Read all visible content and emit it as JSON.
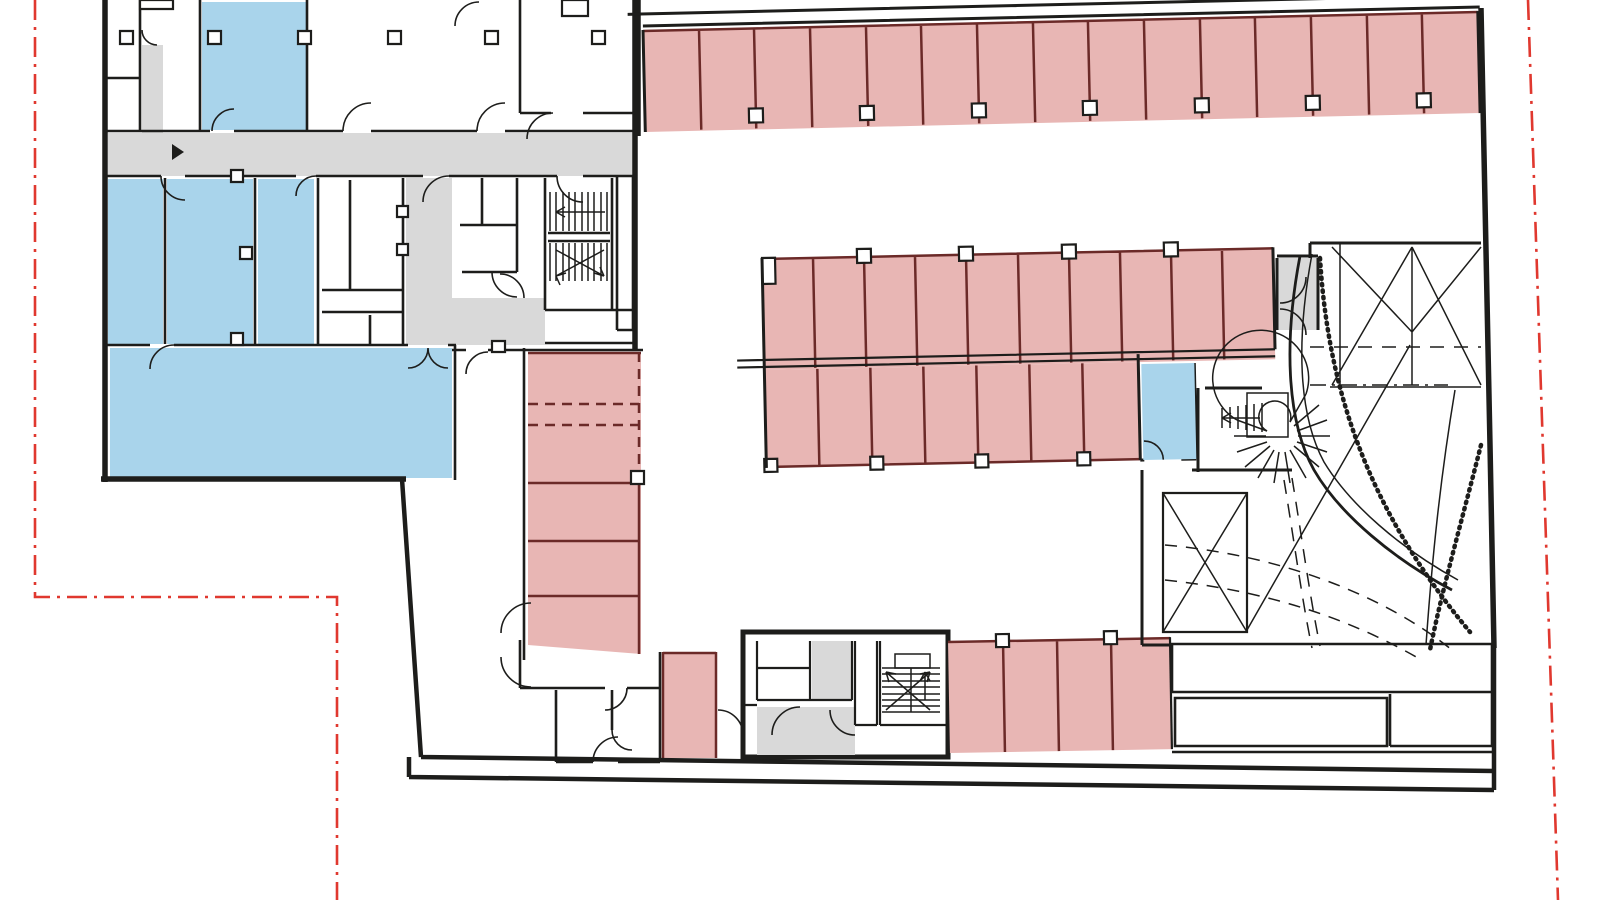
{
  "page": {
    "kind": "architectural floor plan drawing",
    "level": "parking / garage level",
    "visible_text": ""
  },
  "plan": {
    "colors": {
      "wall": "#1d1d1b",
      "parking": "#e8b6b4",
      "stall_line": "#6b2a28",
      "room_blue": "#a9d4eb",
      "circulation": "#d9d9d9",
      "boundary": "#e0382f",
      "ramp_mark": "#9c9c9c",
      "column": "#ffffff",
      "paper": "#ffffff"
    },
    "parking_rows": [
      {
        "id": "north-row",
        "stalls": 15
      },
      {
        "id": "central-north-row",
        "stalls": 10
      },
      {
        "id": "central-south-row",
        "stalls": 7
      },
      {
        "id": "west-column",
        "stalls": 6
      },
      {
        "id": "south-row",
        "stalls": 4
      },
      {
        "id": "south-single-stall",
        "stalls": 1
      }
    ],
    "blue_room_count": 6,
    "features": [
      "northwest-stairwell",
      "south-stairwell",
      "curved-fan-stair",
      "curved-vehicle-ramp",
      "property-boundary-line"
    ]
  }
}
